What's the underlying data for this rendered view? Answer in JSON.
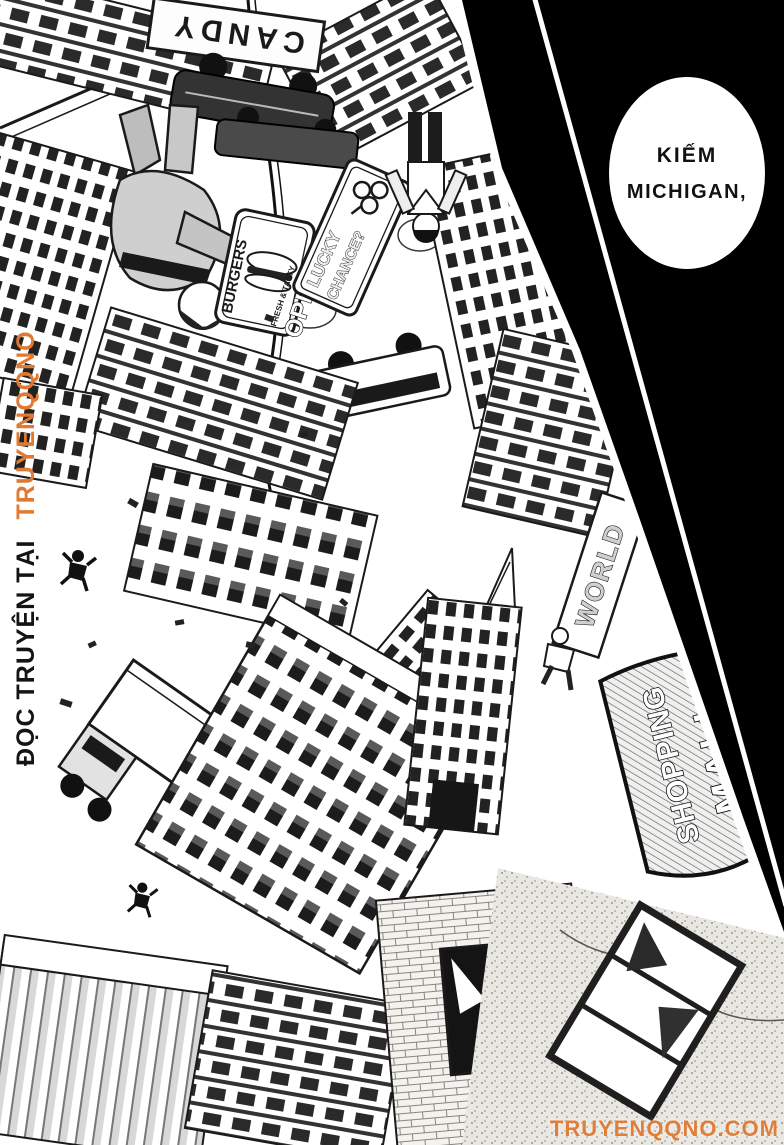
{
  "page": {
    "width": 784,
    "height": 1145,
    "paper_color": "#ffffff",
    "ink_color": "#1a1a1a",
    "panel_black": "#000000",
    "accent_orange": "#e07a32"
  },
  "speech_bubble": {
    "line1": "KIẾM",
    "line2": "MICHIGAN,"
  },
  "scene_signs": {
    "candy": "CANDY",
    "burgers": "BURGERS",
    "fresh_tasty": "FRESH & TASTY",
    "open": "OPEN",
    "lucky": "LUCKY",
    "chance": "CHANCE?",
    "world": "WORLD",
    "shopping": "SHOPPING",
    "mall": "MALL"
  },
  "watermark": {
    "prefix_vertical": "ĐỌC TRUYỆN TẠI",
    "site_vertical": "TRUYENQQNO",
    "footer_url": "TRUYENQQNO.COM",
    "color": "#e07a32"
  }
}
